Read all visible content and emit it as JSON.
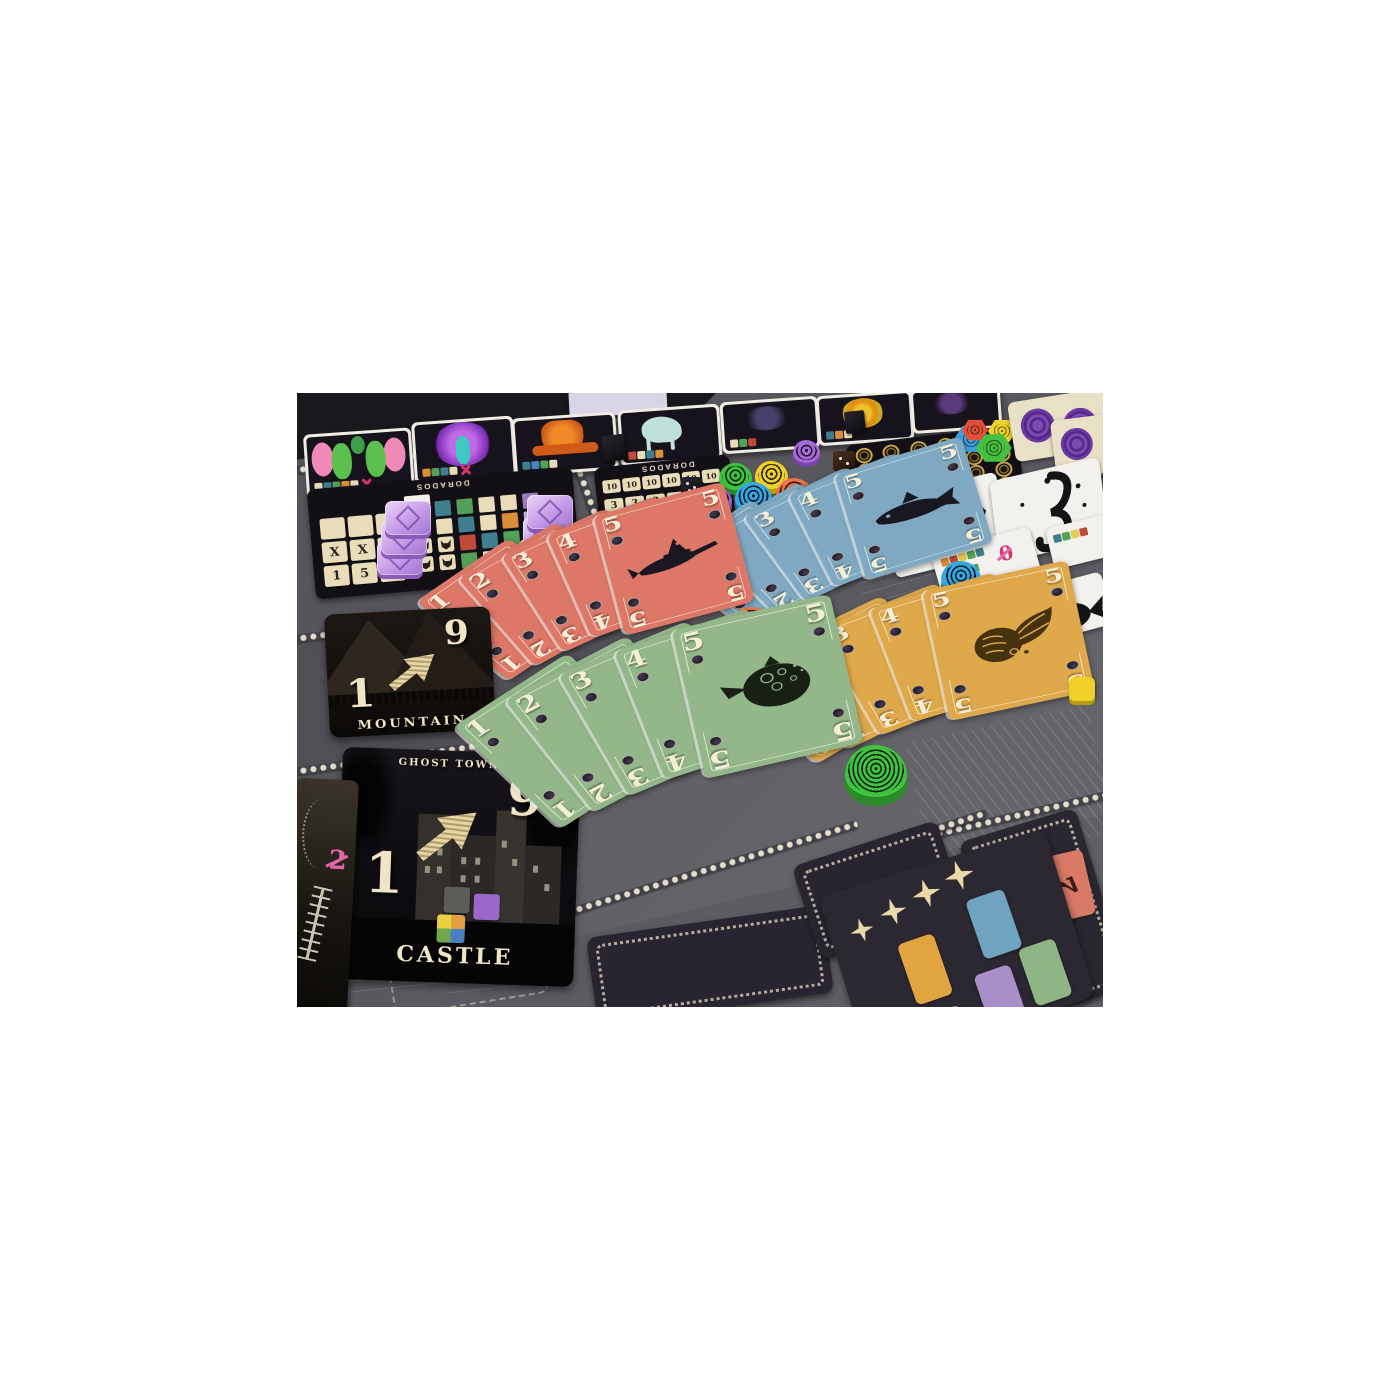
{
  "panels": {
    "left": {
      "title": "DORADOS",
      "tile_rows": [
        [
          "",
          "",
          ""
        ],
        [
          "X",
          "X",
          "X"
        ],
        [
          "1",
          "5",
          "9"
        ]
      ]
    },
    "mid": {
      "title": "DORADOS",
      "row1": [
        "10",
        "10",
        "10",
        "10",
        "10",
        "10"
      ],
      "row2": [
        "3",
        "3",
        "8",
        "8",
        "8"
      ]
    }
  },
  "tiles": {
    "mountain": {
      "label": "MOUNTAIN",
      "low": "1",
      "high": "9"
    },
    "castle": {
      "label": "CASTLE",
      "region": "GHOST TOWN",
      "low": "1",
      "high": "9"
    }
  },
  "fans": [
    {
      "suit": "swordfish",
      "color": "#dd7767",
      "numbers": [
        "1",
        "2",
        "3",
        "4",
        "5"
      ]
    },
    {
      "suit": "cod",
      "color": "#7fa9c2",
      "numbers": [
        "1",
        "2",
        "3",
        "4",
        "5"
      ]
    },
    {
      "suit": "pufferfish",
      "color": "#93b789",
      "numbers": [
        "1",
        "2",
        "3",
        "4",
        "5"
      ]
    },
    {
      "suit": "goldfish",
      "color": "#dfa84b",
      "numbers": [
        "1",
        "2",
        "3",
        "4",
        "5"
      ]
    }
  ],
  "cards": {
    "penalty_value": "2",
    "corner_value": "2",
    "ghost_label": "Ghost",
    "strip_value": "0"
  },
  "tokens": {
    "round_colors": {
      "purple": "#a66ad8",
      "green": "#3fc43f",
      "yellow": "#eed02a",
      "blue": "#35a9e0",
      "orange": "#f0744a"
    },
    "hex_colors": {
      "blue": "#3f9fe0",
      "red": "#e05038",
      "green": "#46c040",
      "yellow": "#f0d228"
    },
    "gem_color": "#c9a0e8",
    "coin_color": "#c9a84c"
  }
}
